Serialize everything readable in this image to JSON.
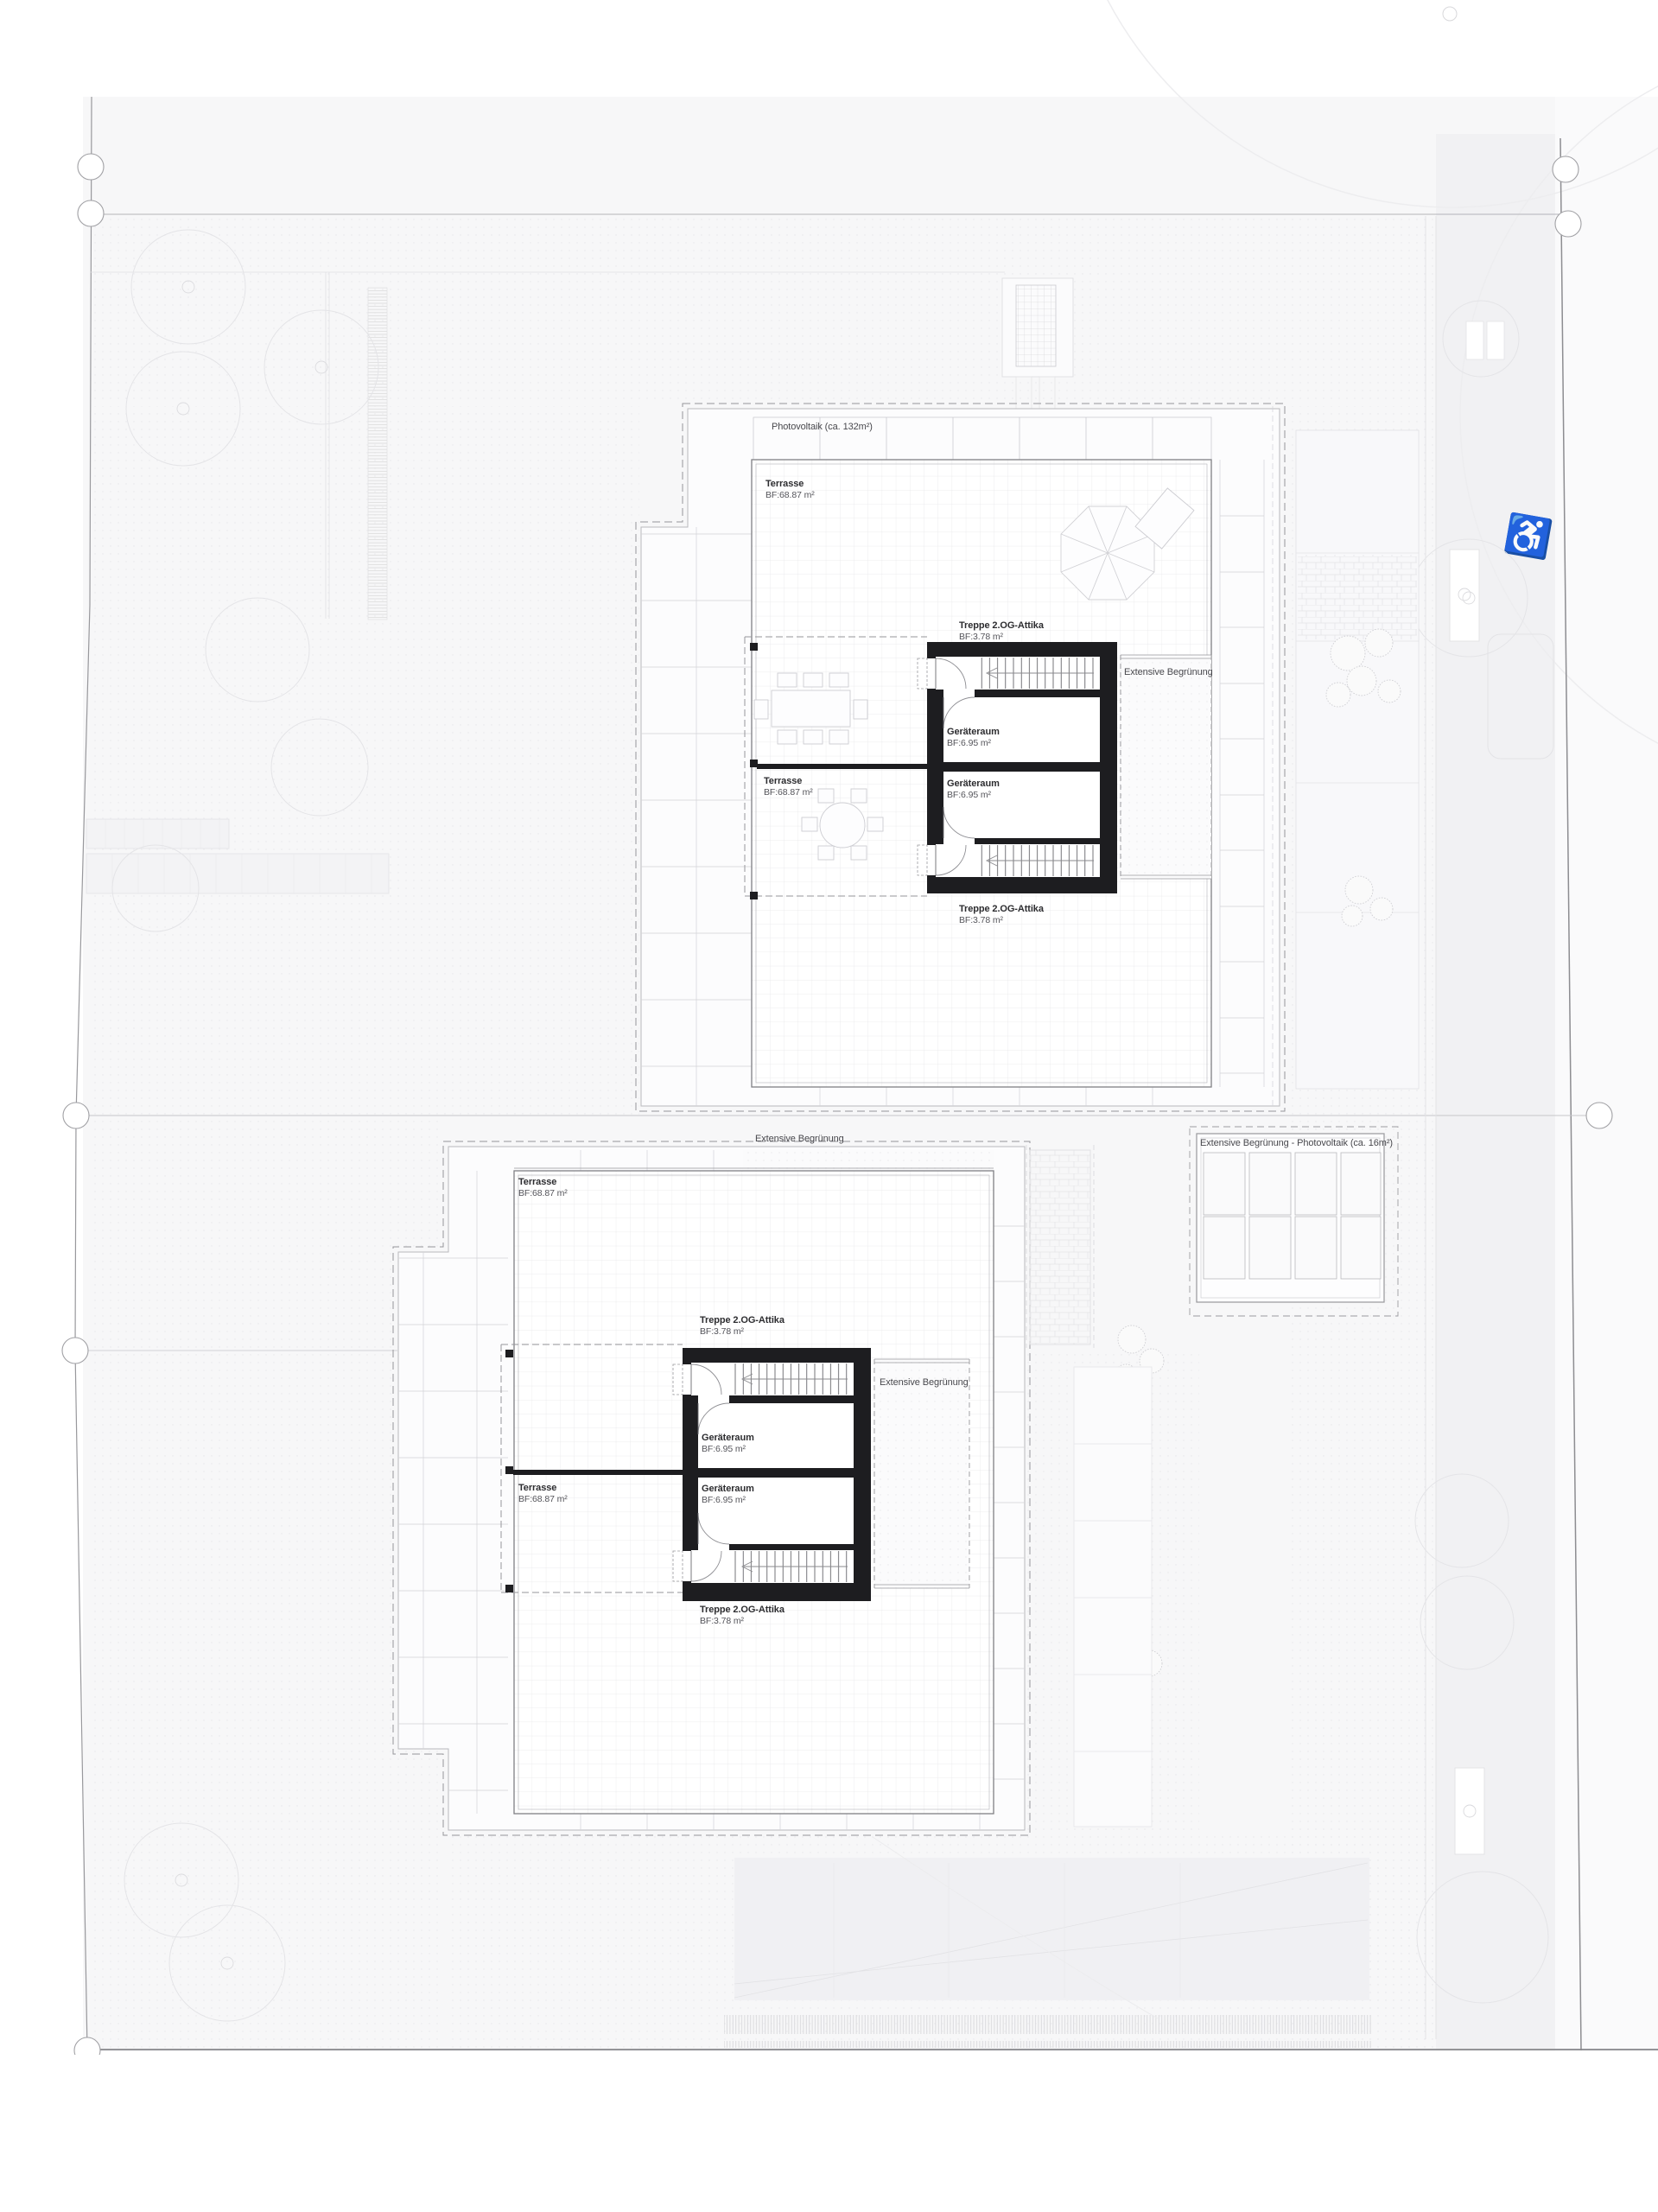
{
  "strings": {
    "photovoltaik": "Photovoltaik (ca. 132m²)",
    "terrasse": "Terrasse",
    "terrasse_bf": "BF:68.87 m²",
    "treppe": "Treppe 2.OG-Attika",
    "treppe_bf": "BF:3.78 m²",
    "geraeteraum": "Geräteraum",
    "geraeteraum_bf": "BF:6.95 m²",
    "extensive": "Extensive Begrünung",
    "extensive_pv": "Extensive Begrünung - Photovoltaik (ca. 16m²)"
  },
  "icons": {
    "wheelchair": "♿"
  },
  "colors": {
    "paper": "#ffffff",
    "site_fill": "#f6f6f8",
    "street_fill": "#f1f1f3",
    "faint_line": "#e4e4e8",
    "mid_line": "#b5b5ba",
    "boundary_line": "#96969b",
    "core_black": "#1d1d20",
    "label_dark": "#2d2d30"
  },
  "plan": {
    "buildings": [
      {
        "id": "upper-house",
        "areas": [
          {
            "label": "Photovoltaik",
            "size": "ca. 132m²"
          },
          {
            "label": "Terrasse",
            "bf": "68.87 m²"
          },
          {
            "label": "Terrasse",
            "bf": "68.87 m²"
          },
          {
            "label": "Treppe 2.OG-Attika",
            "bf": "3.78 m²"
          },
          {
            "label": "Treppe 2.OG-Attika",
            "bf": "3.78 m²"
          },
          {
            "label": "Geräteraum",
            "bf": "6.95 m²"
          },
          {
            "label": "Geräteraum",
            "bf": "6.95 m²"
          },
          {
            "label": "Extensive Begrünung"
          }
        ]
      },
      {
        "id": "lower-house",
        "areas": [
          {
            "label": "Terrasse",
            "bf": "68.87 m²"
          },
          {
            "label": "Terrasse",
            "bf": "68.87 m²"
          },
          {
            "label": "Treppe 2.OG-Attika",
            "bf": "3.78 m²"
          },
          {
            "label": "Treppe 2.OG-Attika",
            "bf": "3.78 m²"
          },
          {
            "label": "Geräteraum",
            "bf": "6.95 m²"
          },
          {
            "label": "Geräteraum",
            "bf": "6.95 m²"
          },
          {
            "label": "Extensive Begrünung"
          },
          {
            "label": "Extensive Begrünung"
          },
          {
            "label": "Extensive Begrünung - Photovoltaik",
            "size": "ca. 16m²"
          }
        ]
      }
    ]
  }
}
